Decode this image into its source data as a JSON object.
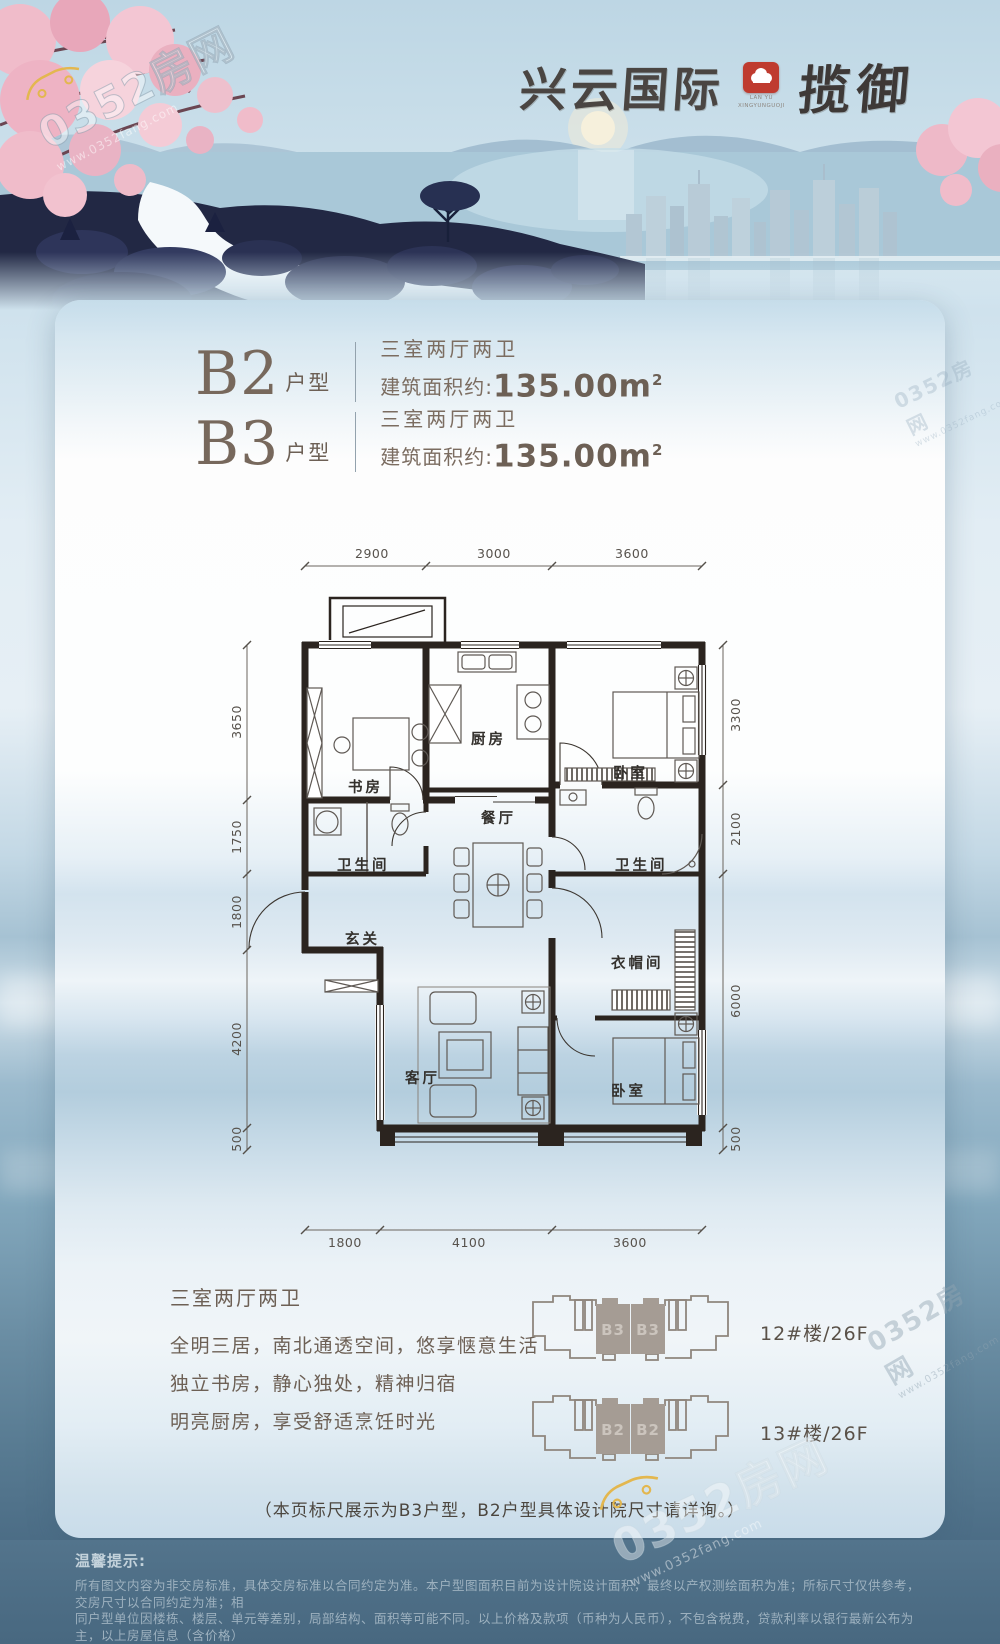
{
  "watermark": {
    "brand": "0352房网",
    "site": "www.0352fang.com"
  },
  "header": {
    "title_main": "兴云国际",
    "title_sub": "揽御",
    "seal_line1": "LAN YU",
    "seal_line2": "XINGYUNGUOJI"
  },
  "units": [
    {
      "code": "B2",
      "suffix": "户型",
      "rooms": "三室两厅两卫",
      "area_prefix": "建筑面积约:",
      "area": "135.00m",
      "area_sup": "2"
    },
    {
      "code": "B3",
      "suffix": "户型",
      "rooms": "三室两厅两卫",
      "area_prefix": "建筑面积约:",
      "area": "135.00m",
      "area_sup": "2"
    }
  ],
  "plan": {
    "rooms": {
      "study": "书房",
      "kitchen": "厨房",
      "dining": "餐厅",
      "bedroom_top": "卧室",
      "bath_left": "卫生间",
      "bath_right": "卫生间",
      "entry": "玄关",
      "cloak": "衣帽间",
      "living": "客厅",
      "bedroom_bottom": "卧室"
    },
    "dims": {
      "top": [
        "2900",
        "3000",
        "3600"
      ],
      "bottom": [
        "1800",
        "4100",
        "3600"
      ],
      "left": [
        "3650",
        "1750",
        "1800",
        "4200",
        "500"
      ],
      "right": [
        "3300",
        "2100",
        "6000",
        "500"
      ]
    }
  },
  "features": {
    "title": "三室两厅两卫",
    "lines": [
      "全明三居，南北通透空间，悠享惬意生活",
      "独立书房，静心独处，精神归宿",
      "明亮厨房，享受舒适烹饪时光"
    ]
  },
  "buildings": [
    {
      "unit_left": "B3",
      "unit_right": "B3",
      "label": "12#楼/26F"
    },
    {
      "unit_left": "B2",
      "unit_right": "B2",
      "label": "13#楼/26F"
    }
  ],
  "note": "（本页标尺展示为B3户型，B2户型具体设计院尺寸请详询。）",
  "footer": {
    "title": "温馨提示:",
    "lines": [
      "所有图文内容为非交房标准，具体交房标准以合同约定为准。本户型图面积目前为设计院设计面积，最终以产权测绘面积为准；所标尺寸仅供参考，交房尺寸以合同约定为准；相",
      "同户型单位因楼栋、楼层、单元等差别，局部结构、面积等可能不同。以上价格及款项（币种为人民币），不包含税费，贷款利率以银行最新公布为主，以上房屋信息（含价格）",
      "仅供参考，本公司保留对价格进行调整的权利，具体房屋价格以双方签署的商品房买卖合同为准，如有变化，恕不另行通知。"
    ]
  },
  "colors": {
    "seal_red": "#bf3b2f",
    "footer_bg": "#4d6d85",
    "text_brown": "#6d6055"
  }
}
